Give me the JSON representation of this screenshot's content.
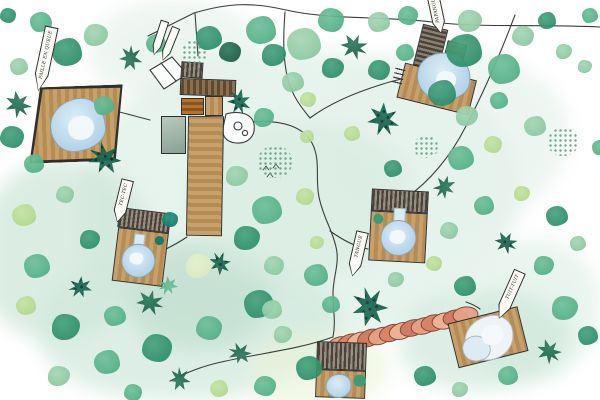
{
  "map": {
    "kind": "illustrated-resort-site-plan",
    "cabin_labels": [
      {
        "id": "paille-en-queue",
        "text": "PAILLE EN QUEUE"
      },
      {
        "id": "tec-tec",
        "text": "TEC-TEC"
      },
      {
        "id": "tangue",
        "text": "TANGUE"
      },
      {
        "id": "tuit-tuit",
        "text": "TUIT-TUIT"
      },
      {
        "id": "papangue",
        "text": "PAPANGUE"
      }
    ],
    "palette": {
      "wash_green": "#dcefe6",
      "tree_dark": "#1b5e49",
      "tree_mid": "#2e8f6b",
      "tree_light": "#8cc9a0",
      "tree_lime": "#b3d98e",
      "tree_teal": "#157c68",
      "deck_wood": "#c8a06a",
      "roof_dark": "#4a4138",
      "roof_orange": "#b5732c",
      "pool_blue": "#bcd9ec",
      "walkway_coral": "#e8a184",
      "path_ink": "#3c3c3c"
    }
  }
}
